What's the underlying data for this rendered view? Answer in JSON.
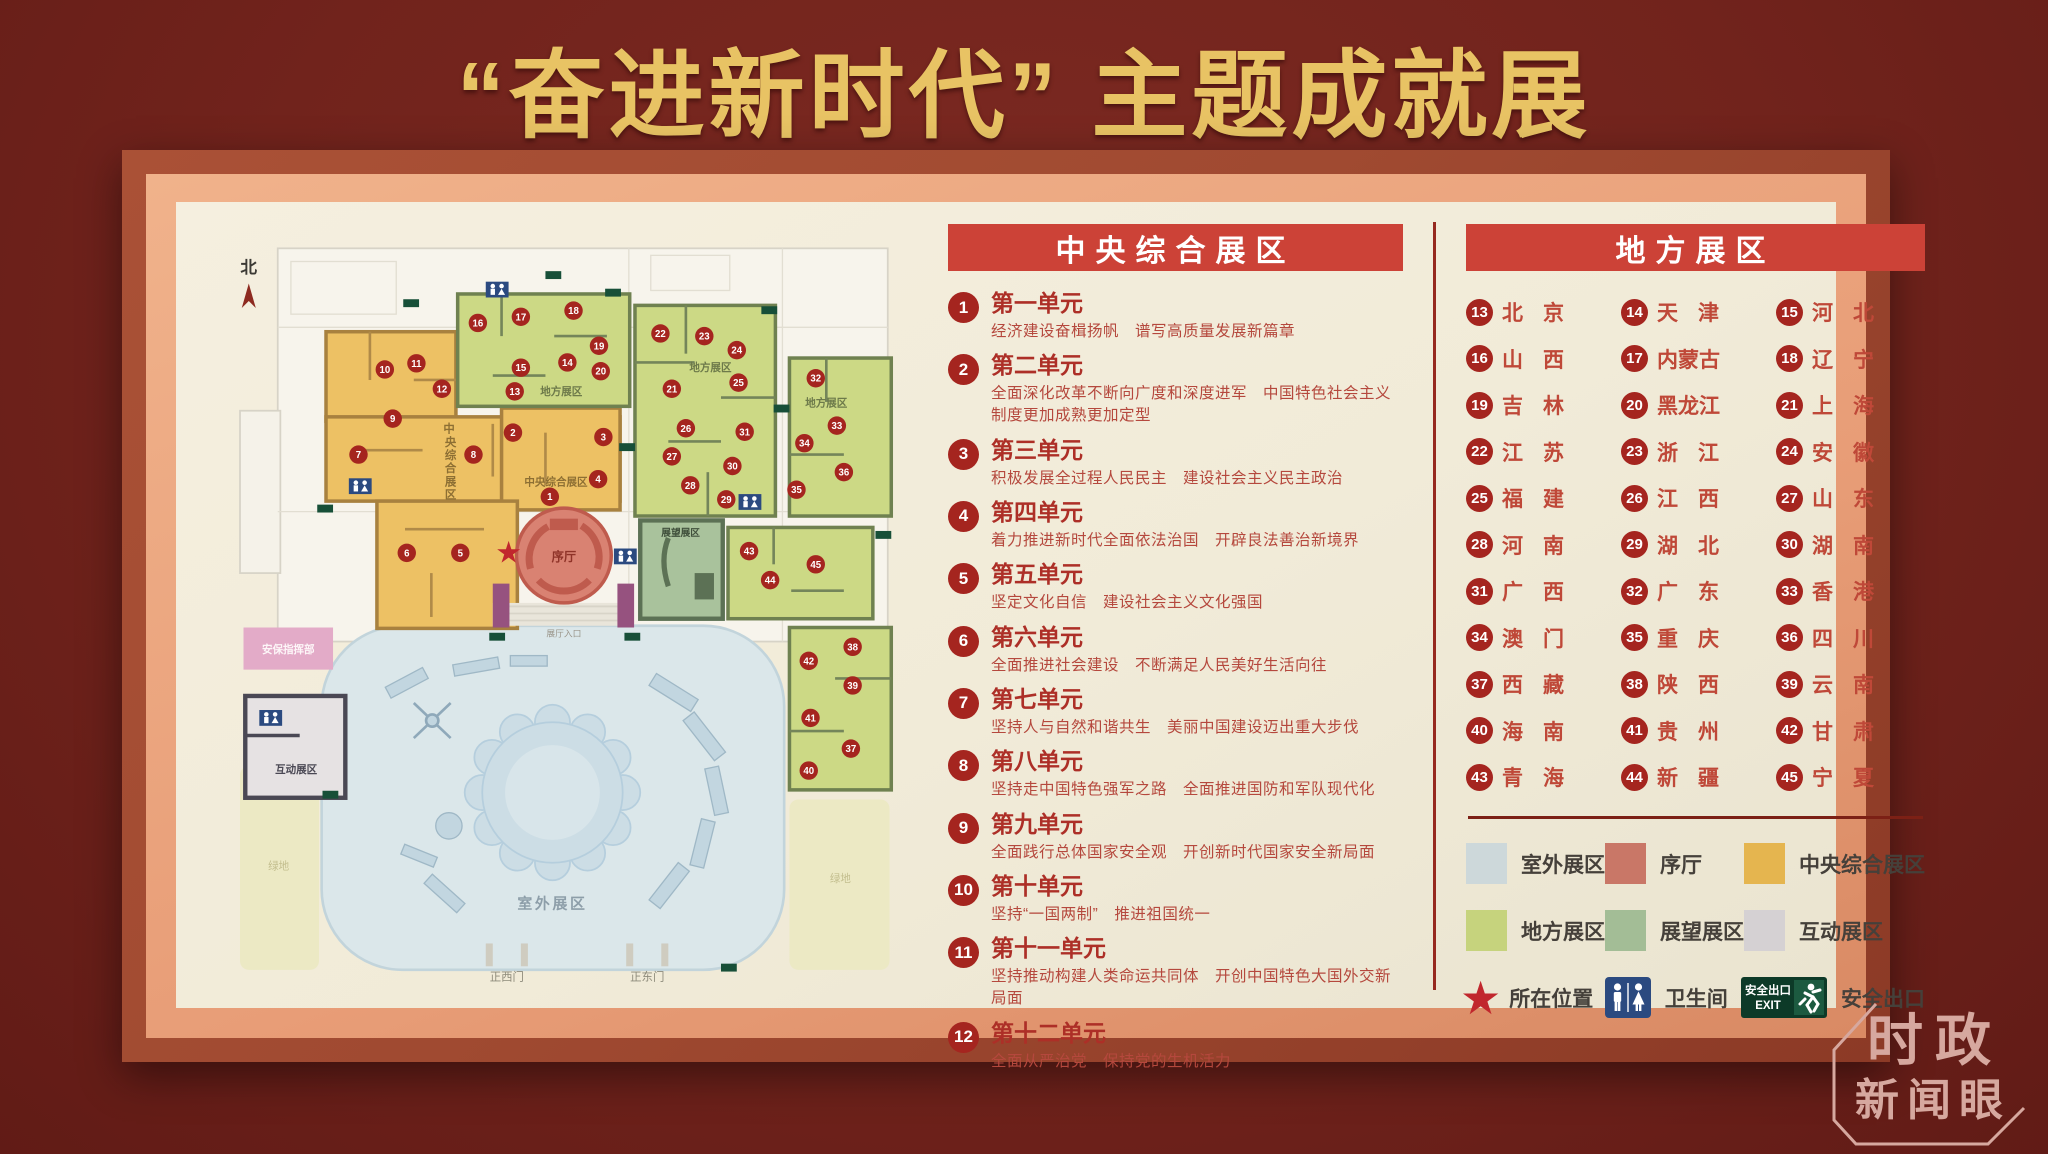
{
  "page_title": "“奋进新时代” 主题成就展",
  "board": {
    "central": {
      "header": "中央综合展区",
      "units": [
        {
          "num": "1",
          "title": "第一单元",
          "desc": "经济建设奋楫扬帆　谱写高质量发展新篇章"
        },
        {
          "num": "2",
          "title": "第二单元",
          "desc": "全面深化改革不断向广度和深度进军　中国特色社会主义制度更加成熟更加定型"
        },
        {
          "num": "3",
          "title": "第三单元",
          "desc": "积极发展全过程人民民主　建设社会主义民主政治"
        },
        {
          "num": "4",
          "title": "第四单元",
          "desc": "着力推进新时代全面依法治国　开辟良法善治新境界"
        },
        {
          "num": "5",
          "title": "第五单元",
          "desc": "坚定文化自信　建设社会主义文化强国"
        },
        {
          "num": "6",
          "title": "第六单元",
          "desc": "全面推进社会建设　不断满足人民美好生活向往"
        },
        {
          "num": "7",
          "title": "第七单元",
          "desc": "坚持人与自然和谐共生　美丽中国建设迈出重大步伐"
        },
        {
          "num": "8",
          "title": "第八单元",
          "desc": "坚持走中国特色强军之路　全面推进国防和军队现代化"
        },
        {
          "num": "9",
          "title": "第九单元",
          "desc": "全面践行总体国家安全观　开创新时代国家安全新局面"
        },
        {
          "num": "10",
          "title": "第十单元",
          "desc": "坚持“一国两制”　推进祖国统一"
        },
        {
          "num": "11",
          "title": "第十一单元",
          "desc": "坚持推动构建人类命运共同体　开创中国特色大国外交新局面"
        },
        {
          "num": "12",
          "title": "第十二单元",
          "desc": "全面从严治党　保持党的生机活力"
        }
      ]
    },
    "local": {
      "header": "地方展区",
      "provinces": [
        {
          "num": "13",
          "name": "北京"
        },
        {
          "num": "14",
          "name": "天津"
        },
        {
          "num": "15",
          "name": "河北"
        },
        {
          "num": "16",
          "name": "山西"
        },
        {
          "num": "17",
          "name": "内蒙古"
        },
        {
          "num": "18",
          "name": "辽宁"
        },
        {
          "num": "19",
          "name": "吉林"
        },
        {
          "num": "20",
          "name": "黑龙江"
        },
        {
          "num": "21",
          "name": "上海"
        },
        {
          "num": "22",
          "name": "江苏"
        },
        {
          "num": "23",
          "name": "浙江"
        },
        {
          "num": "24",
          "name": "安徽"
        },
        {
          "num": "25",
          "name": "福建"
        },
        {
          "num": "26",
          "name": "江西"
        },
        {
          "num": "27",
          "name": "山东"
        },
        {
          "num": "28",
          "name": "河南"
        },
        {
          "num": "29",
          "name": "湖北"
        },
        {
          "num": "30",
          "name": "湖南"
        },
        {
          "num": "31",
          "name": "广西"
        },
        {
          "num": "32",
          "name": "广东"
        },
        {
          "num": "33",
          "name": "香港"
        },
        {
          "num": "34",
          "name": "澳门"
        },
        {
          "num": "35",
          "name": "重庆"
        },
        {
          "num": "36",
          "name": "四川"
        },
        {
          "num": "37",
          "name": "西藏"
        },
        {
          "num": "38",
          "name": "陕西"
        },
        {
          "num": "39",
          "name": "云南"
        },
        {
          "num": "40",
          "name": "海南"
        },
        {
          "num": "41",
          "name": "贵州"
        },
        {
          "num": "42",
          "name": "甘肃"
        },
        {
          "num": "43",
          "name": "青海"
        },
        {
          "num": "44",
          "name": "新疆"
        },
        {
          "num": "45",
          "name": "宁夏"
        }
      ]
    },
    "legend": {
      "zones": [
        {
          "label": "室外展区",
          "color": "#cdd8da"
        },
        {
          "label": "序厅",
          "color": "#c97767"
        },
        {
          "label": "中央综合展区",
          "color": "#e5b54f"
        },
        {
          "label": "地方展区",
          "color": "#c6d37d"
        },
        {
          "label": "展望展区",
          "color": "#a3bd96"
        },
        {
          "label": "互动展区",
          "color": "#d5d1d3"
        }
      ],
      "location_label": "所在位置",
      "restroom_label": "卫生间",
      "exit_label": "安全出口",
      "exit_sign_line1": "安全出口",
      "exit_sign_line2": "EXIT"
    },
    "map": {
      "north_label": "北",
      "labels": {
        "central_left_vertical": "中央综合展区",
        "central_main": "中央综合展区",
        "local_a": "地方展区",
        "local_b": "地方展区",
        "local_c": "地方展区",
        "foyer": "序厅",
        "prospect": "展望展区",
        "interactive": "互动展区",
        "security_hq": "安保指挥部",
        "outdoor": "室外展区",
        "lawn_left": "绿地",
        "lawn_right": "绿地",
        "gate_west": "正西门",
        "gate_east": "正东门",
        "hall_entrance": "展厅入口"
      },
      "markers": [
        {
          "n": 1,
          "x": 365,
          "y": 313
        },
        {
          "n": 2,
          "x": 323,
          "y": 240
        },
        {
          "n": 3,
          "x": 426,
          "y": 245
        },
        {
          "n": 4,
          "x": 420,
          "y": 293
        },
        {
          "n": 5,
          "x": 263,
          "y": 377
        },
        {
          "n": 6,
          "x": 202,
          "y": 377
        },
        {
          "n": 7,
          "x": 147,
          "y": 265
        },
        {
          "n": 8,
          "x": 278,
          "y": 265
        },
        {
          "n": 9,
          "x": 186,
          "y": 224
        },
        {
          "n": 10,
          "x": 177,
          "y": 168
        },
        {
          "n": 11,
          "x": 213,
          "y": 161
        },
        {
          "n": 12,
          "x": 242,
          "y": 190
        },
        {
          "n": 13,
          "x": 325,
          "y": 193
        },
        {
          "n": 14,
          "x": 385,
          "y": 160
        },
        {
          "n": 15,
          "x": 332,
          "y": 166
        },
        {
          "n": 16,
          "x": 283,
          "y": 115
        },
        {
          "n": 17,
          "x": 332,
          "y": 108
        },
        {
          "n": 18,
          "x": 392,
          "y": 101
        },
        {
          "n": 19,
          "x": 421,
          "y": 141
        },
        {
          "n": 20,
          "x": 423,
          "y": 170
        },
        {
          "n": 21,
          "x": 504,
          "y": 190
        },
        {
          "n": 22,
          "x": 491,
          "y": 127
        },
        {
          "n": 23,
          "x": 541,
          "y": 130
        },
        {
          "n": 24,
          "x": 578,
          "y": 146
        },
        {
          "n": 25,
          "x": 580,
          "y": 183
        },
        {
          "n": 26,
          "x": 520,
          "y": 235
        },
        {
          "n": 27,
          "x": 504,
          "y": 267
        },
        {
          "n": 28,
          "x": 525,
          "y": 300
        },
        {
          "n": 29,
          "x": 566,
          "y": 316
        },
        {
          "n": 30,
          "x": 573,
          "y": 278
        },
        {
          "n": 31,
          "x": 587,
          "y": 239
        },
        {
          "n": 32,
          "x": 668,
          "y": 178
        },
        {
          "n": 33,
          "x": 692,
          "y": 232
        },
        {
          "n": 34,
          "x": 655,
          "y": 252
        },
        {
          "n": 35,
          "x": 646,
          "y": 305
        },
        {
          "n": 36,
          "x": 700,
          "y": 285
        },
        {
          "n": 37,
          "x": 708,
          "y": 600
        },
        {
          "n": 38,
          "x": 710,
          "y": 484
        },
        {
          "n": 39,
          "x": 710,
          "y": 528
        },
        {
          "n": 40,
          "x": 660,
          "y": 625
        },
        {
          "n": 41,
          "x": 662,
          "y": 565
        },
        {
          "n": 42,
          "x": 660,
          "y": 500
        },
        {
          "n": 43,
          "x": 592,
          "y": 375
        },
        {
          "n": 44,
          "x": 616,
          "y": 408
        },
        {
          "n": 45,
          "x": 668,
          "y": 390
        }
      ]
    }
  },
  "watermark": {
    "line1": "时政",
    "line2": "新闻眼"
  }
}
